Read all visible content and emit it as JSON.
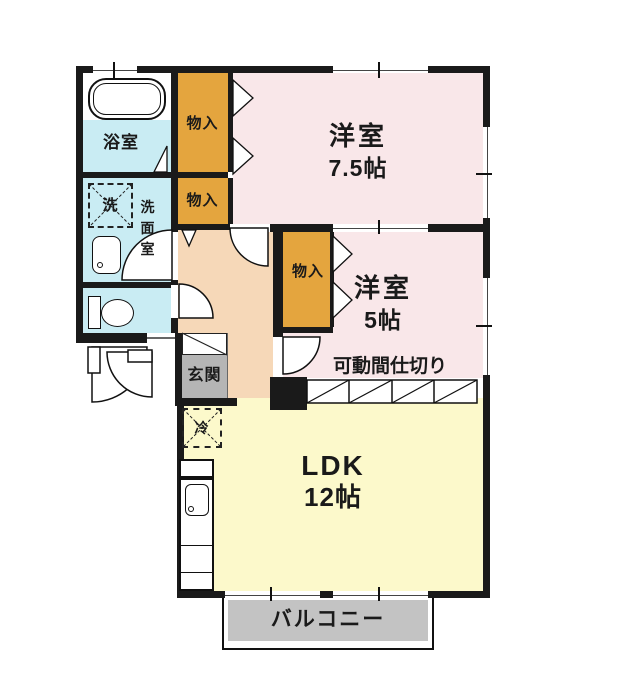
{
  "plan_type": "apartment-floor-plan",
  "rooms": {
    "bedroom1": {
      "name": "洋室",
      "size": "7.5帖"
    },
    "bedroom2": {
      "name": "洋室",
      "size": "5帖"
    },
    "ldk": {
      "name": "LDK",
      "size": "12帖"
    },
    "bath": {
      "label": "浴室"
    },
    "washroom": {
      "label": "洗面室"
    },
    "entrance": {
      "label": "玄関"
    },
    "balcony": {
      "label": "バルコニー"
    },
    "partition": {
      "label": "可動間仕切り"
    },
    "closet": {
      "label": "物入"
    }
  },
  "symbols": {
    "washer": "洗",
    "fridge": "冷"
  },
  "colors": {
    "wall": "#1a1a1a",
    "bedroom": "#f9e7e9",
    "ldk": "#fcf9cb",
    "corridor": "#f6d8b8",
    "closet": "#e4a53e",
    "water": "#c9ecf3",
    "entrance_floor": "#b5b5b5",
    "balcony": "#c3c3c3"
  }
}
